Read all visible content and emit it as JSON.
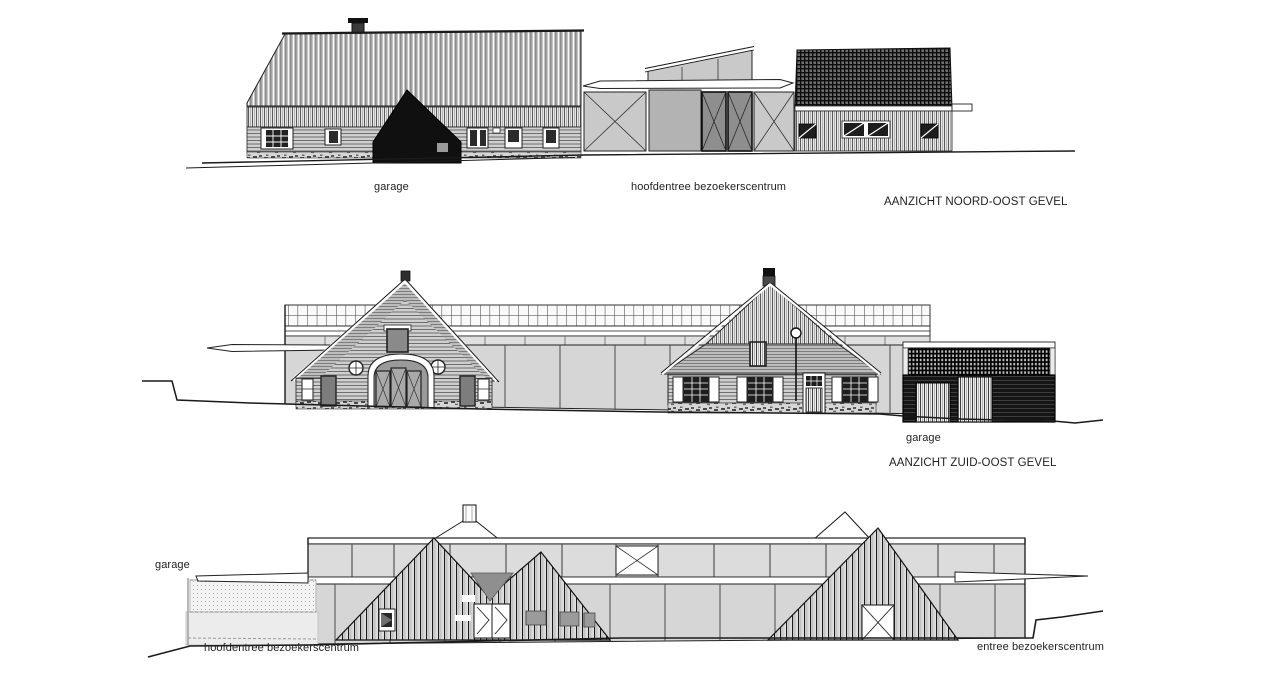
{
  "palette": {
    "paper": "#ffffff",
    "ink": "#1a1a1a",
    "dark_fill": "#101010",
    "panel_light": "#d6d6d6",
    "panel_mid": "#b3b3b3",
    "text": "#222222"
  },
  "elevations": [
    {
      "id": "noord-oost",
      "title": "AANZICHT NOORD-OOST GEVEL",
      "labels": {
        "garage": "garage",
        "main_entrance": "hoofdentree bezoekerscentrum"
      }
    },
    {
      "id": "zuid-oost",
      "title": "AANZICHT ZUID-OOST GEVEL",
      "labels": {
        "garage": "garage"
      }
    },
    {
      "id": "entree",
      "labels": {
        "garage": "garage",
        "main_entrance": "hoofdentree bezoekerscentrum",
        "entrance": "entree bezoekerscentrum"
      }
    }
  ]
}
